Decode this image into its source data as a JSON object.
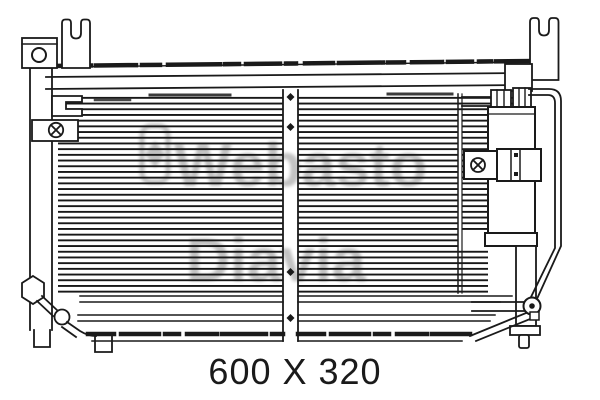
{
  "dimension_label": "600 X 320",
  "watermark": {
    "brand_primary": "Webasto",
    "brand_secondary": "Diavia"
  },
  "colors": {
    "line": "#1a1a1a",
    "background": "#ffffff",
    "watermark_gray": "#8f8f8f"
  }
}
